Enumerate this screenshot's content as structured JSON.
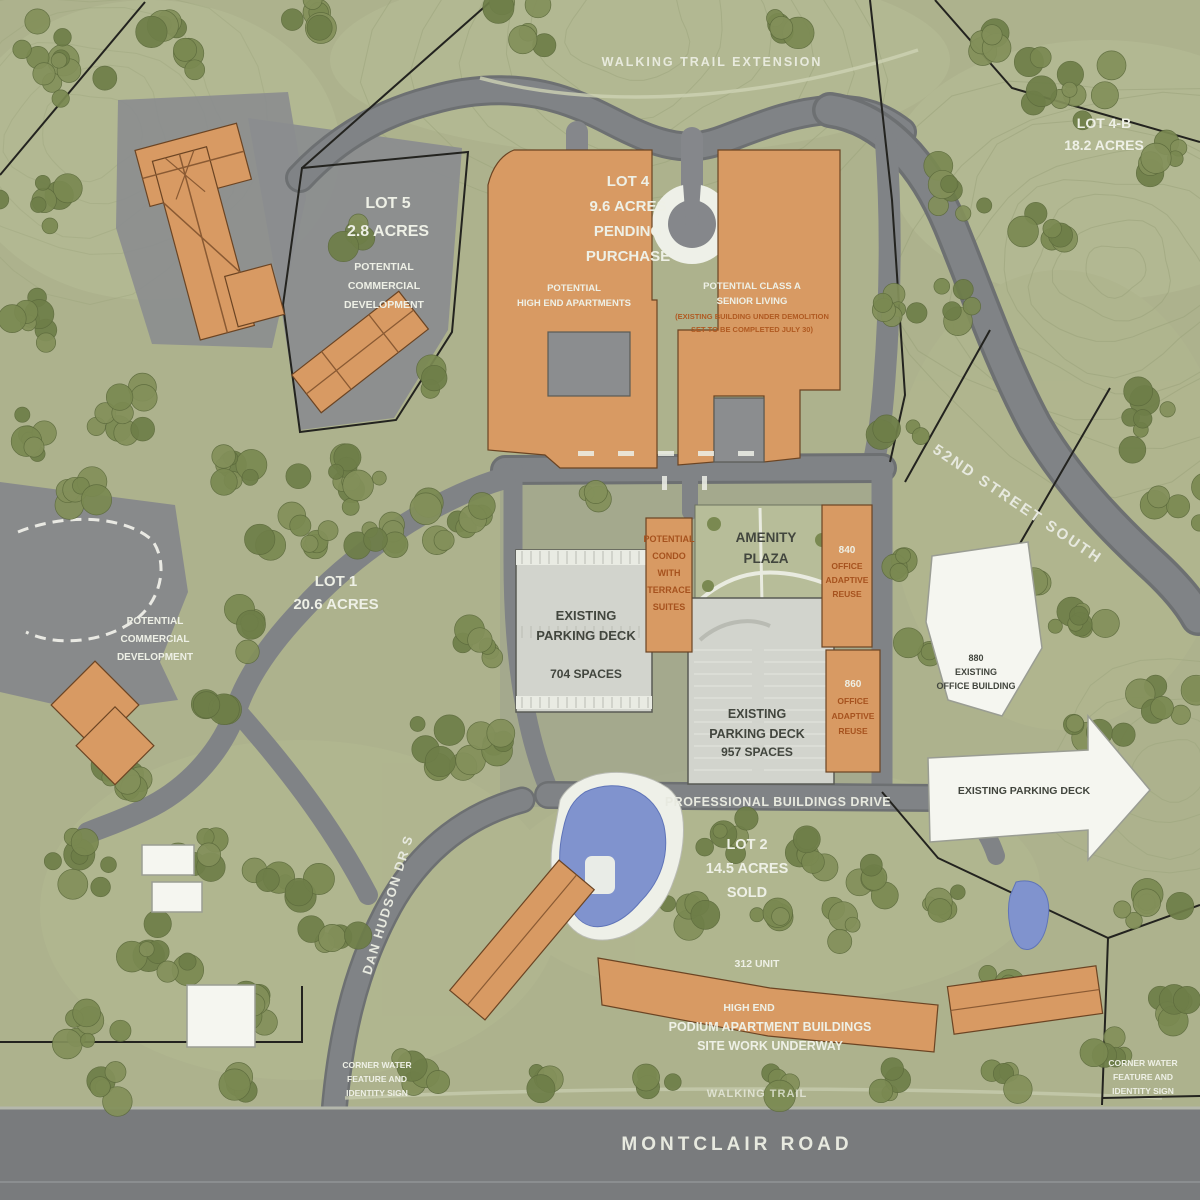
{
  "colors": {
    "ground": "#adb28d",
    "tree_green": "#75854e",
    "road_gray": "#7f8284",
    "building_orange": "#d89a63",
    "white_building": "#f5f6f0",
    "parking_deck_gray": "#d2d4cd",
    "water_blue": "#8093ce",
    "boundary_black": "#23231f",
    "montclair_gray": "#797b7d"
  },
  "labels": {
    "walking_trail_extension": "WALKING TRAIL EXTENSION",
    "lot5": {
      "lines": [
        "LOT 5",
        "2.8 ACRES"
      ]
    },
    "lot5_use": {
      "lines": [
        "POTENTIAL",
        "COMMERCIAL",
        "DEVELOPMENT"
      ]
    },
    "lot4": {
      "lines": [
        "LOT 4",
        "9.6 ACRES",
        "PENDING",
        "PURCHASE"
      ]
    },
    "lot4b": {
      "lines": [
        "LOT 4-B",
        "18.2 ACRES"
      ]
    },
    "lot1": {
      "lines": [
        "LOT 1",
        "20.6 ACRES"
      ]
    },
    "lot1_use": {
      "lines": [
        "POTENTIAL",
        "COMMERCIAL",
        "DEVELOPMENT"
      ]
    },
    "lot2": {
      "lines": [
        "LOT 2",
        "14.5 ACRES",
        "SOLD"
      ]
    },
    "apartments_potential": {
      "lines": [
        "POTENTIAL",
        "HIGH END APARTMENTS"
      ]
    },
    "senior_living": {
      "lines": [
        "POTENTIAL CLASS A",
        "SENIOR LIVING"
      ]
    },
    "senior_living_note": {
      "lines": [
        "(EXISTING BUILDING UNDER DEMOLITION",
        "SET TO BE COMPLETED JULY 30)"
      ]
    },
    "condo": {
      "lines": [
        "POTENTIAL",
        "CONDO",
        "WITH",
        "TERRACE",
        "SUITES"
      ]
    },
    "office_840": {
      "number": "840",
      "lines": [
        "OFFICE",
        "ADAPTIVE",
        "REUSE"
      ]
    },
    "office_860": {
      "number": "860",
      "lines": [
        "OFFICE",
        "ADAPTIVE",
        "REUSE"
      ]
    },
    "parking_deck_704": {
      "lines": [
        "EXISTING",
        "PARKING DECK",
        "704  SPACES"
      ]
    },
    "parking_deck_957": {
      "lines": [
        "EXISTING",
        "PARKING DECK",
        "957 SPACES"
      ]
    },
    "office_880": {
      "lines": [
        "880",
        "EXISTING",
        "OFFICE BUILDING"
      ]
    },
    "existing_parking_deck_arrow": "EXISTING PARKING DECK",
    "amenity_plaza": {
      "lines": [
        "AMENITY",
        "PLAZA"
      ]
    },
    "podium_apartments": {
      "lines": [
        "312 UNIT",
        "HIGH END",
        "PODIUM APARTMENT BUILDINGS",
        "SITE WORK UNDERWAY"
      ]
    },
    "corner_water_left": {
      "lines": [
        "CORNER WATER",
        "FEATURE AND",
        "IDENTITY SIGN"
      ]
    },
    "corner_water_right": {
      "lines": [
        "CORNER WATER",
        "FEATURE AND",
        "IDENTITY SIGN"
      ]
    },
    "walking_trail": "WALKING TRAIL",
    "streets": {
      "fifty_second": "52ND STREET SOUTH",
      "professional": "PROFESSIONAL BUILDINGS DRIVE",
      "dan_hudson": "DAN HUDSON DR S",
      "montclair": "MONTCLAIR ROAD"
    }
  }
}
